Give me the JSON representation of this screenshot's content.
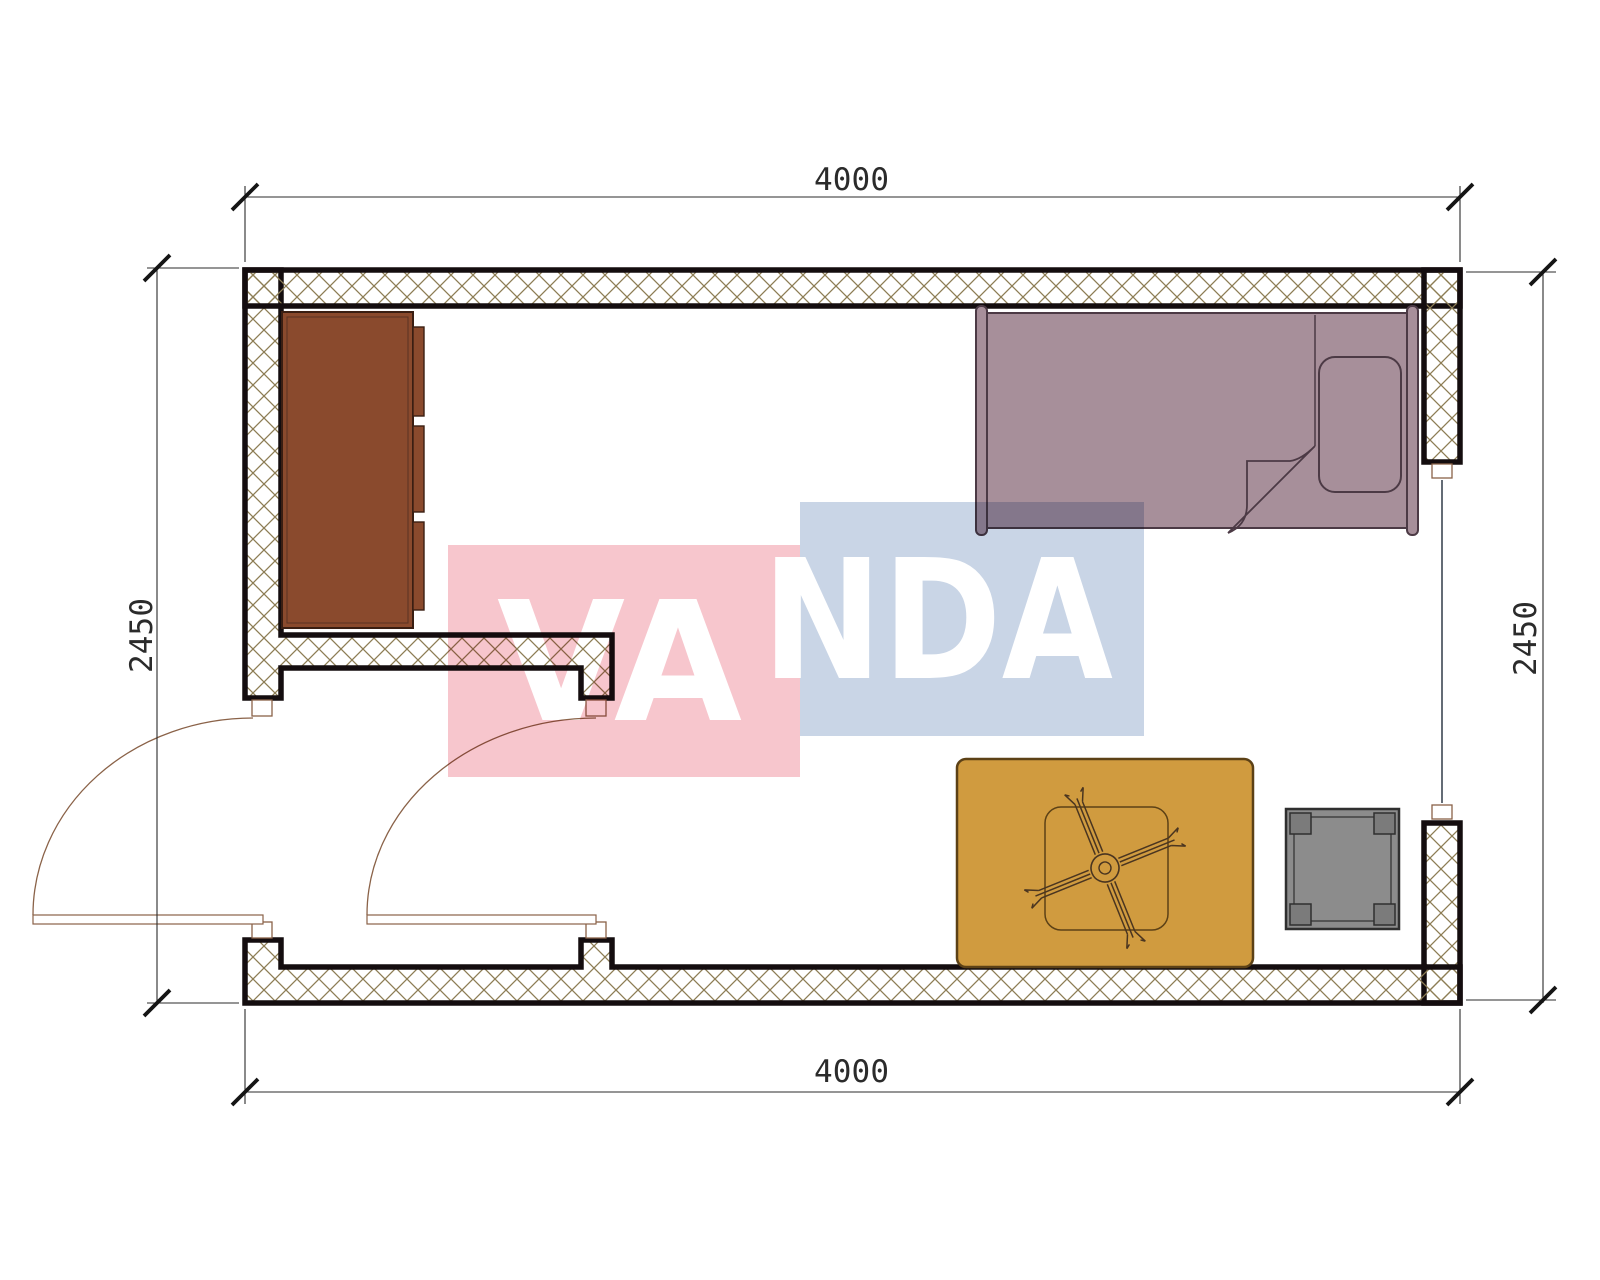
{
  "document": {
    "type": "architectural-floor-plan"
  },
  "dimensions": {
    "top": "4000",
    "bottom": "4000",
    "left": "2450",
    "right": "2450"
  },
  "watermark": {
    "text_left": "VA",
    "text_right": "NDA"
  },
  "colors": {
    "watermark_pink": "#f7c6cd",
    "watermark_blue": "#c9d5e6",
    "watermark_text": "#ffffff",
    "wall_hatch": "#8d7d55",
    "wall_outline": "#140d0f",
    "wardrobe": "#8a4a2d",
    "wardrobe_outline": "#3a1e12",
    "bed": "#a78f9a",
    "bed_outline": "#4c3a45",
    "rug": "#d09b3f",
    "rug_outline": "#5c4116",
    "stool": "#8c8c8c",
    "stool_outline": "#2f2f2f",
    "door": "#8a6248",
    "window": "#3d4754",
    "dimension": "#2b2b2b"
  }
}
